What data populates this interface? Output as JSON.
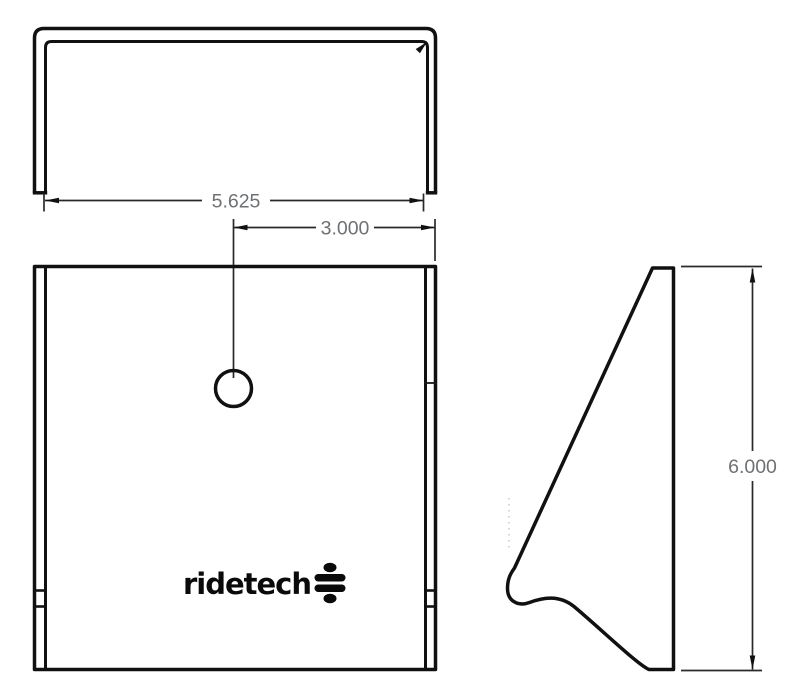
{
  "drawing": {
    "type": "technical-drawing",
    "part": "bracket",
    "background_color": "#ffffff",
    "line_color": "#111111",
    "dim_text_color": "#6e7174",
    "views": [
      {
        "id": "top-view",
        "description": "u-channel viewed from top"
      },
      {
        "id": "front-view",
        "description": "square face with center hole and logo"
      },
      {
        "id": "side-view",
        "description": "gusset profile with curved relief"
      }
    ],
    "dimensions": {
      "channel_width": {
        "value": "5.625"
      },
      "hole_offset": {
        "value": "3.000"
      },
      "overall_height": {
        "value": "6.000"
      }
    },
    "logo": {
      "text": "ridetech",
      "mark": "ridetech-shock-mark-icon"
    }
  }
}
